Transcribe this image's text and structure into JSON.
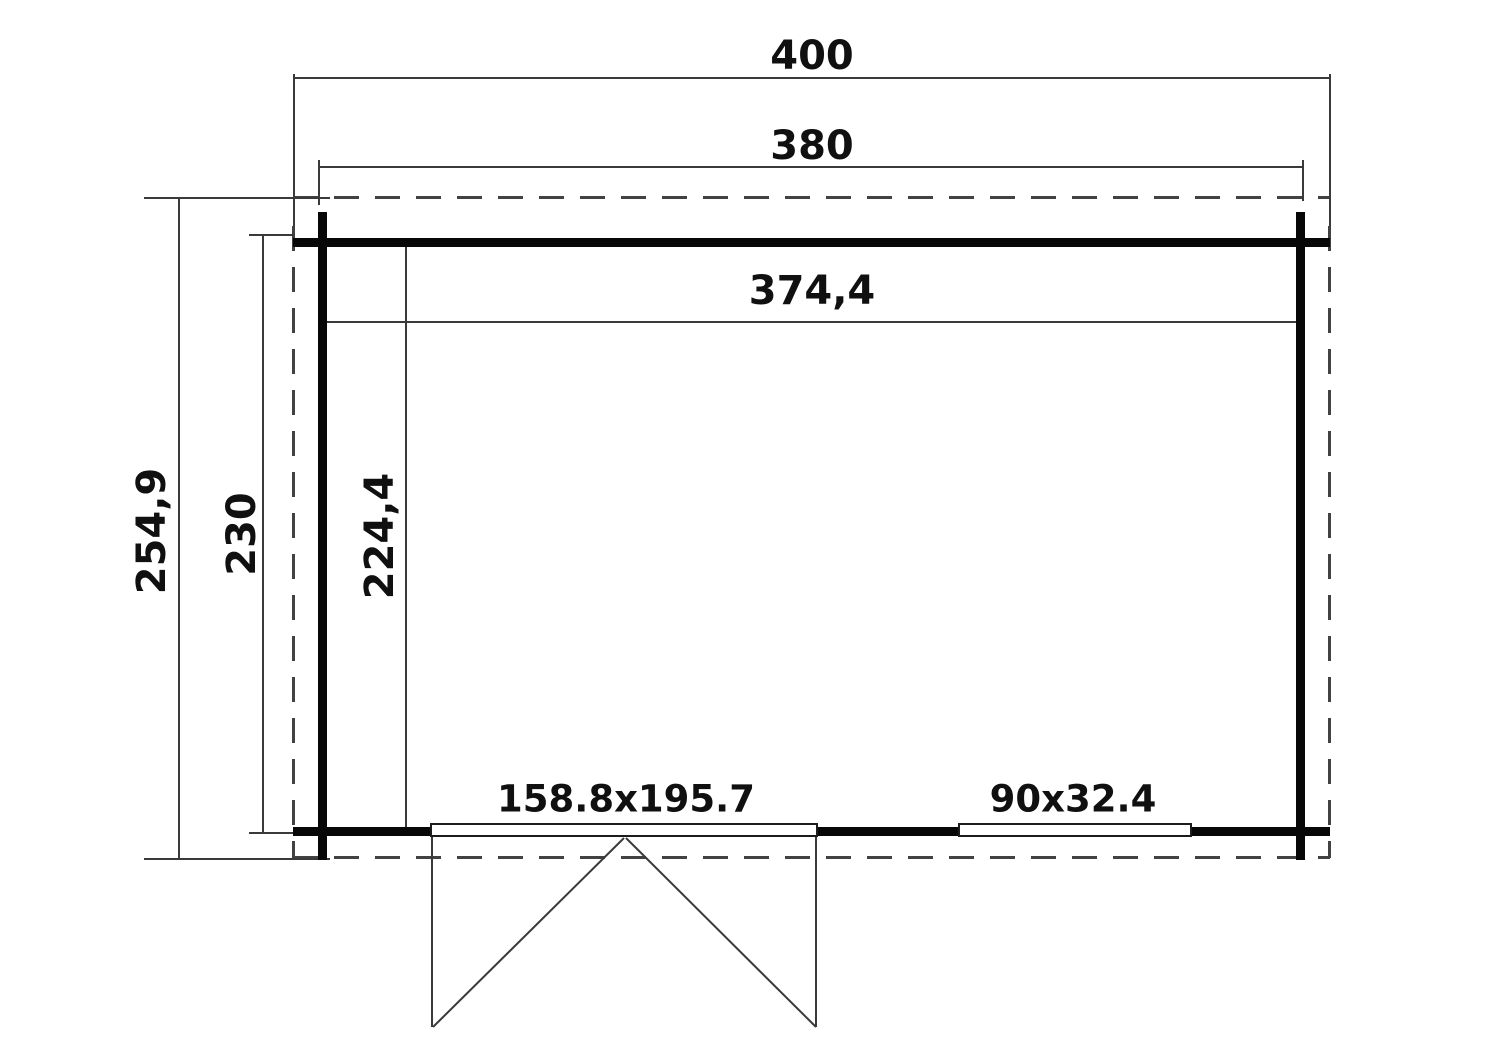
{
  "drawing": {
    "type": "floor-plan",
    "horizontal_dimensions": {
      "overall": "400",
      "outer_wall": "380",
      "interior": "374,4"
    },
    "vertical_dimensions": {
      "overall": "254,9",
      "outer_wall": "230",
      "interior": "224,4"
    },
    "openings": {
      "double_door": "158.8x195.7",
      "window": "90x32.4"
    },
    "colors": {
      "background": "#ffffff",
      "wall": "#070707",
      "line": "#3a3a3a",
      "dashed_outline": "#424242",
      "text": "#101010"
    }
  }
}
